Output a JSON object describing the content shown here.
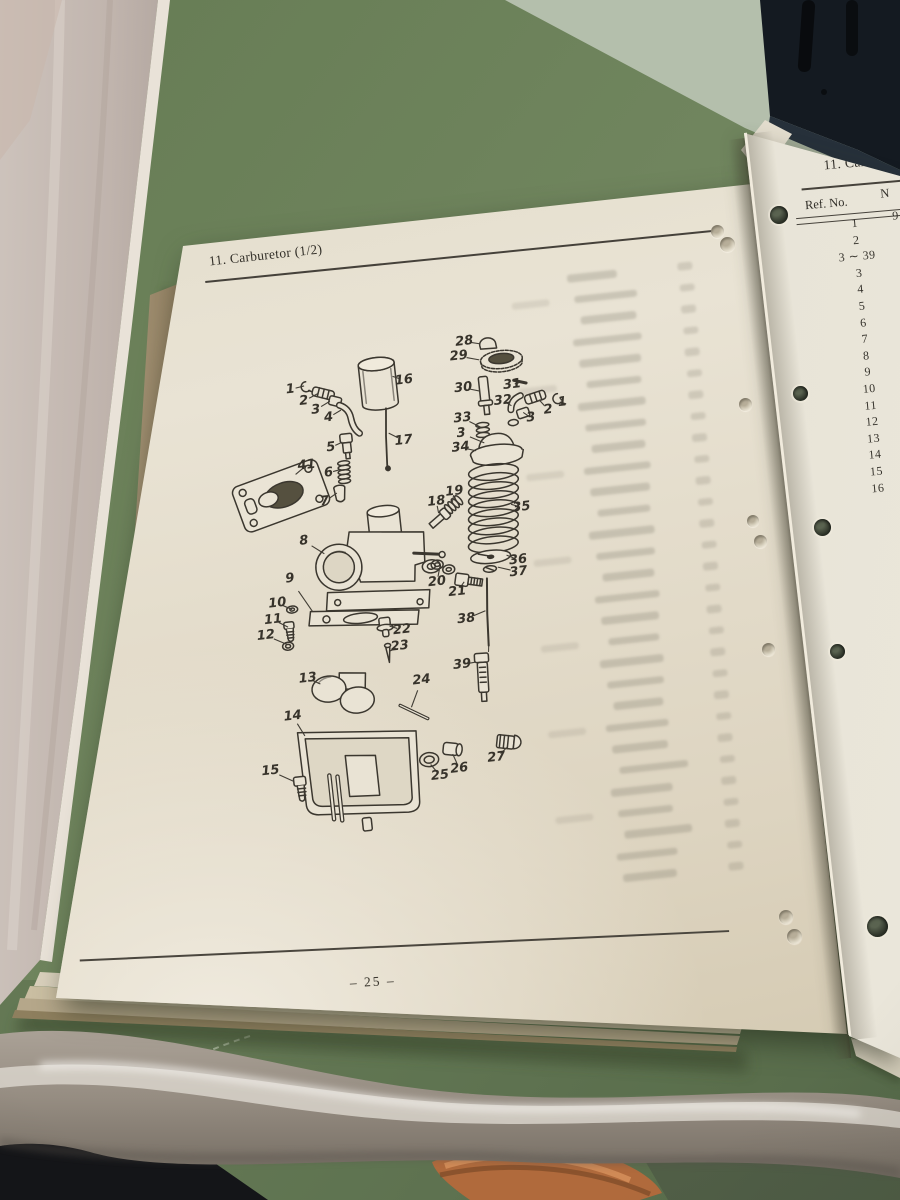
{
  "photo": {
    "left_page": {
      "page_code": "F6",
      "section_title": "11. Carburetor (1/2)",
      "page_number": "– 25 –",
      "diagram_labels": [
        {
          "t": "1",
          "x": 123,
          "y": 214,
          "tx": 137,
          "ty": 212
        },
        {
          "t": "2",
          "x": 135,
          "y": 227,
          "tx": 150,
          "ty": 221
        },
        {
          "t": "3",
          "x": 146,
          "y": 237,
          "tx": 161,
          "ty": 230
        },
        {
          "t": "4",
          "x": 158,
          "y": 246,
          "tx": 171,
          "ty": 240
        },
        {
          "t": "5",
          "x": 157,
          "y": 276,
          "tx": 169,
          "ty": 272
        },
        {
          "t": "6",
          "x": 152,
          "y": 301,
          "tx": 164,
          "ty": 299
        },
        {
          "t": "7",
          "x": 145,
          "y": 329,
          "tx": 158,
          "ty": 322
        },
        {
          "t": "8",
          "x": 120,
          "y": 366,
          "tx": 139,
          "ty": 381
        },
        {
          "t": "9",
          "x": 102,
          "y": 402,
          "tx": 121,
          "ty": 437
        },
        {
          "t": "10",
          "x": 87,
          "y": 425,
          "tx": 101,
          "ty": 433
        },
        {
          "t": "11",
          "x": 81,
          "y": 441,
          "tx": 95,
          "ty": 450
        },
        {
          "t": "12",
          "x": 72,
          "y": 456,
          "tx": 92,
          "ty": 467
        },
        {
          "t": "13",
          "x": 109,
          "y": 503,
          "tx": 121,
          "ty": 510
        },
        {
          "t": "14",
          "x": 90,
          "y": 539,
          "tx": 100,
          "ty": 560
        },
        {
          "t": "15",
          "x": 62,
          "y": 591,
          "tx": 84,
          "ty": 604
        },
        {
          "t": "16",
          "x": 237,
          "y": 217,
          "tx": 226,
          "ty": 212
        },
        {
          "t": "17",
          "x": 230,
          "y": 277,
          "tx": 216,
          "ty": 268
        },
        {
          "t": "18",
          "x": 256,
          "y": 341,
          "tx": 257,
          "ty": 353
        },
        {
          "t": "19",
          "x": 275,
          "y": 333,
          "tx": 272,
          "ty": 343
        },
        {
          "t": "20",
          "x": 248,
          "y": 421,
          "tx": 252,
          "ty": 408
        },
        {
          "t": "21",
          "x": 267,
          "y": 433,
          "tx": 275,
          "ty": 424
        },
        {
          "t": "22",
          "x": 208,
          "y": 465,
          "tx": 196,
          "ty": 460
        },
        {
          "t": "23",
          "x": 204,
          "y": 481,
          "tx": 193,
          "ty": 485
        },
        {
          "t": "24",
          "x": 222,
          "y": 517,
          "tx": 209,
          "ty": 543
        },
        {
          "t": "25",
          "x": 230,
          "y": 614,
          "tx": 222,
          "ty": 602
        },
        {
          "t": "26",
          "x": 250,
          "y": 609,
          "tx": 245,
          "ty": 594
        },
        {
          "t": "27",
          "x": 288,
          "y": 602,
          "tx": 300,
          "ty": 593
        },
        {
          "t": "28",
          "x": 301,
          "y": 185,
          "tx": 316,
          "ty": 189
        },
        {
          "t": "29",
          "x": 294,
          "y": 199,
          "tx": 314,
          "ty": 205
        },
        {
          "t": "30",
          "x": 295,
          "y": 231,
          "tx": 311,
          "ty": 236
        },
        {
          "t": "31",
          "x": 344,
          "y": 233,
          "tx": 351,
          "ty": 232
        },
        {
          "t": "32",
          "x": 333,
          "y": 248,
          "tx": 341,
          "ty": 254
        },
        {
          "t": "33",
          "x": 291,
          "y": 261,
          "tx": 308,
          "ty": 272
        },
        {
          "t": "3",
          "x": 288,
          "y": 276,
          "tx": 310,
          "ty": 288
        },
        {
          "t": "34",
          "x": 286,
          "y": 290,
          "tx": 301,
          "ty": 295
        },
        {
          "t": "35",
          "x": 340,
          "y": 356,
          "tx": 330,
          "ty": 352
        },
        {
          "t": "36",
          "x": 331,
          "y": 408,
          "tx": 320,
          "ty": 402
        },
        {
          "t": "37",
          "x": 330,
          "y": 420,
          "tx": 310,
          "ty": 413
        },
        {
          "t": "38",
          "x": 273,
          "y": 461,
          "tx": 293,
          "ty": 455
        },
        {
          "t": "39",
          "x": 264,
          "y": 506,
          "tx": 278,
          "ty": 505
        },
        {
          "t": "41",
          "x": 131,
          "y": 291,
          "tx": 119,
          "ty": 299
        },
        {
          "t": "2",
          "x": 377,
          "y": 262,
          "tx": 369,
          "ty": 251
        },
        {
          "t": "1",
          "x": 392,
          "y": 256,
          "tx": 390,
          "ty": 251
        },
        {
          "t": "3",
          "x": 359,
          "y": 268,
          "tx": 352,
          "ty": 262
        }
      ]
    },
    "right_page": {
      "section_title_visible": "11. Carbure",
      "table": {
        "col1_header": "Ref. No.",
        "col2_header_visible": "N",
        "part_no_fragment": "9",
        "ref_rows": [
          "1",
          "2",
          "3 ∼ 39",
          "3",
          "4",
          "5",
          "6",
          "7",
          "8",
          "9",
          "10",
          "11",
          "12",
          "13",
          "14",
          "15",
          "16"
        ]
      }
    }
  }
}
